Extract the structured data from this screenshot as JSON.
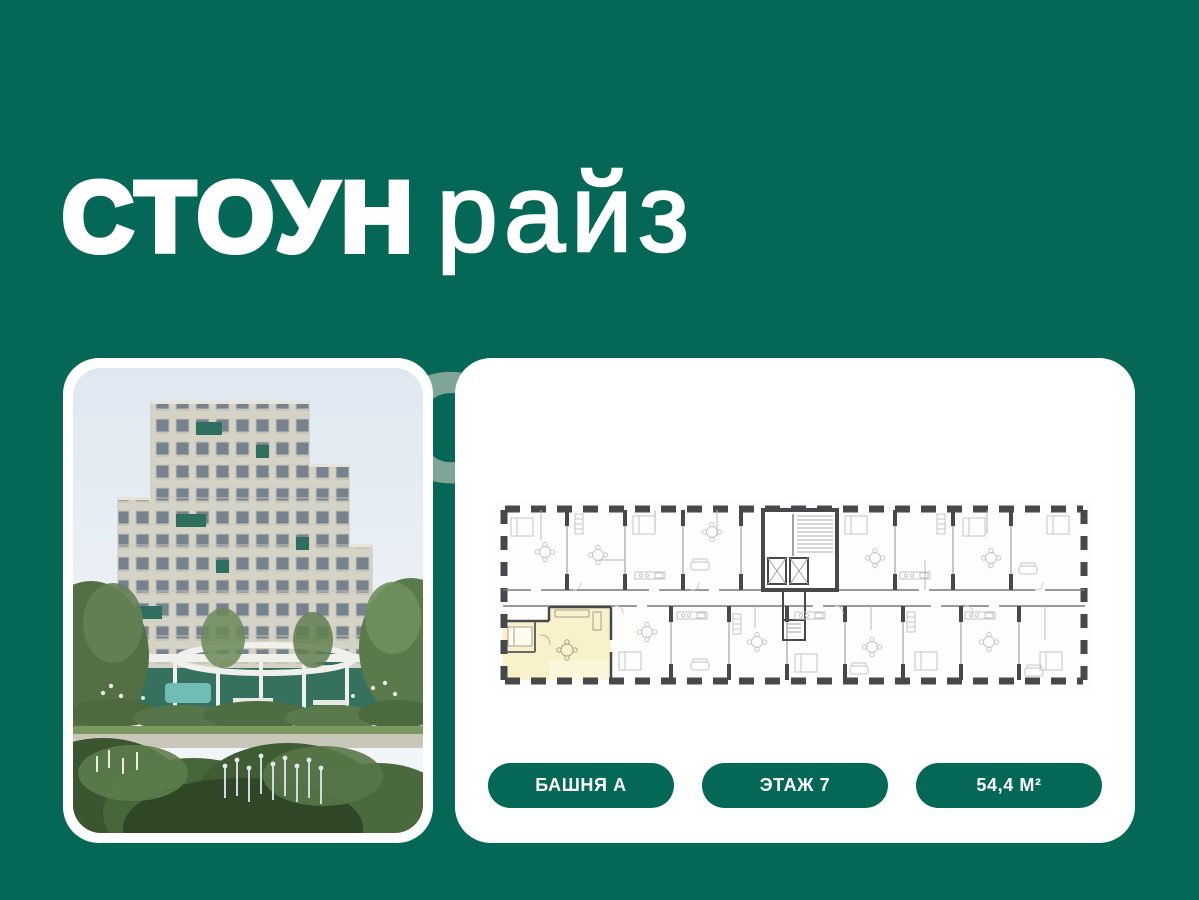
{
  "logo": {
    "word1": "СТОУН",
    "word2": "райз"
  },
  "watermark": {
    "text": "СТОУН"
  },
  "photo_card": {
    "photo_label": "building-exterior-photo"
  },
  "plan_card": {
    "badges": [
      {
        "label": "БАШНЯ А"
      },
      {
        "label": "ЭТАЖ 7"
      },
      {
        "label": "54,4 М²"
      }
    ]
  },
  "colors": {
    "background": "#056857",
    "card": "#ffffff",
    "badge": "#056857",
    "badge_text": "#ffffff",
    "highlighted_unit": "#f8f1c9",
    "plan_walls": "#47484a",
    "watermark": "#7fa596"
  }
}
